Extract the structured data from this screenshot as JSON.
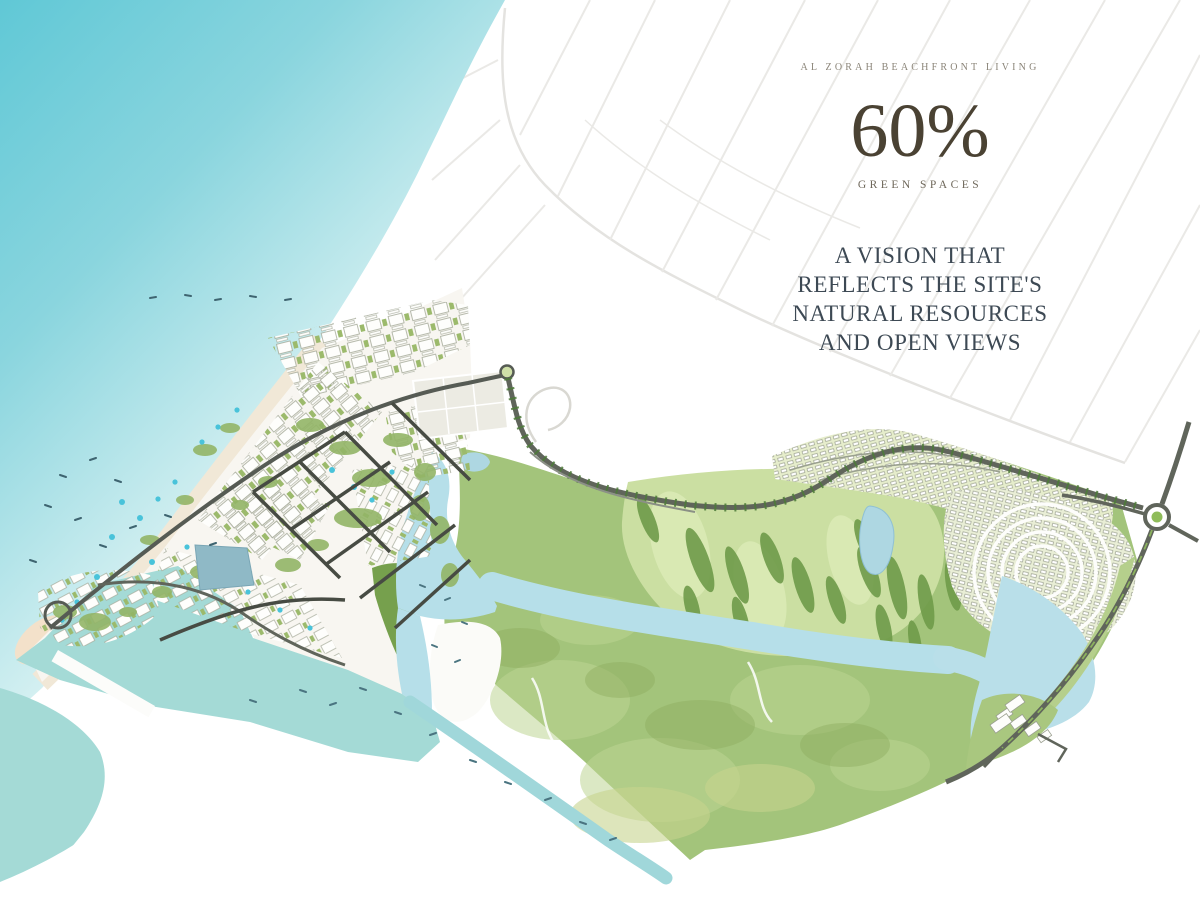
{
  "overlay": {
    "tagline": "AL ZORAH BEACHFRONT LIVING",
    "stat_value": "60%",
    "stat_label": "GREEN SPACES",
    "headline_lines": [
      "A VISION THAT",
      "REFLECTS THE SITE'S",
      "NATURAL RESOURCES",
      "AND OPEN VIEWS"
    ]
  },
  "map": {
    "features": [
      "open-sea",
      "beach",
      "resort-peninsula",
      "downtown-district",
      "marina-creek",
      "breakwater",
      "mangrove-island",
      "winding-lagoon",
      "golf-course",
      "villa-communities",
      "tree-lined-boulevard",
      "highway",
      "roundabout",
      "lagoon-lake",
      "waterfront-cluster"
    ],
    "palette": {
      "sea": "#63c9d7",
      "marina_water": "#a4dad6",
      "lagoon": "#b6dfe9",
      "green_base": "#a3c47b",
      "golf_green": "#cbdfa2",
      "dark_trees": "#6f9b4a",
      "sand": "#f1e8d7",
      "road_dark": "#565b54",
      "headline_text": "#3d4954",
      "stat_text": "#4a4233",
      "tagline_text": "#8b8579"
    }
  }
}
